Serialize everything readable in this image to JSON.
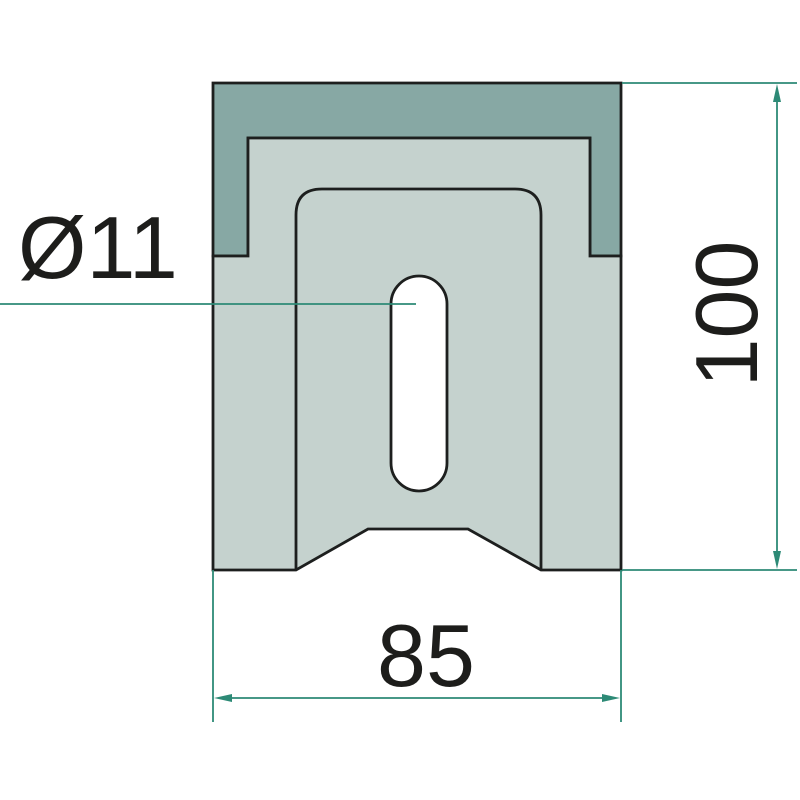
{
  "drawing": {
    "type": "technical-drawing",
    "part": "mounting block front view with slotted hole",
    "labels": {
      "hole_diameter": "Ø11",
      "height": "100",
      "width": "85"
    },
    "dimensions": {
      "hole_diameter_mm": 11,
      "height_mm": 100,
      "width_mm": 85
    },
    "colors": {
      "background": "#ffffff",
      "part_dark_fill": "#87a8a4",
      "part_light_fill": "#c5d2ce",
      "outline": "#1d1f1e",
      "dimension_line": "#2d8a76",
      "text": "#1d1d1b"
    }
  }
}
